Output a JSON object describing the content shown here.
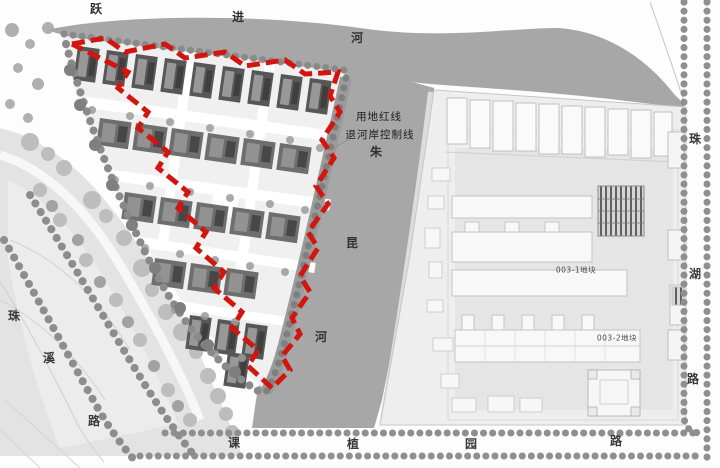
{
  "map": {
    "rivers": {
      "yuejin": {
        "full": "跃进河",
        "chars": [
          "跃",
          "进",
          "河"
        ]
      },
      "zhukun": {
        "full": "朱昆河",
        "chars": [
          "朱",
          "昆",
          "河"
        ]
      }
    },
    "roads": {
      "zhuxi": {
        "full": "珠溪路",
        "chars": [
          "珠",
          "溪",
          "路"
        ]
      },
      "kezhiyuan": {
        "full": "课植园路",
        "chars": [
          "课",
          "植",
          "园",
          "路"
        ]
      },
      "zhuhu": {
        "full": "珠湖路",
        "chars": [
          "珠",
          "湖",
          "路"
        ]
      }
    },
    "annotations": {
      "site_red_line": "用地红线",
      "riverbank_control_line": "退河岸控制线"
    },
    "parcels": {
      "parcel_003_1": "003-1地块",
      "parcel_003_2": "003-2地块"
    },
    "colors": {
      "boundary_red": "#d2150f",
      "river_gray": "#a7a7a7",
      "shore_gray": "#949494",
      "park_gray": "#e3e3e3",
      "tree_gray": "#9c9c9c",
      "building_dark": "#575757",
      "parcel_fill": "#eeeeee",
      "label_dark": "#2b2b2b"
    }
  }
}
